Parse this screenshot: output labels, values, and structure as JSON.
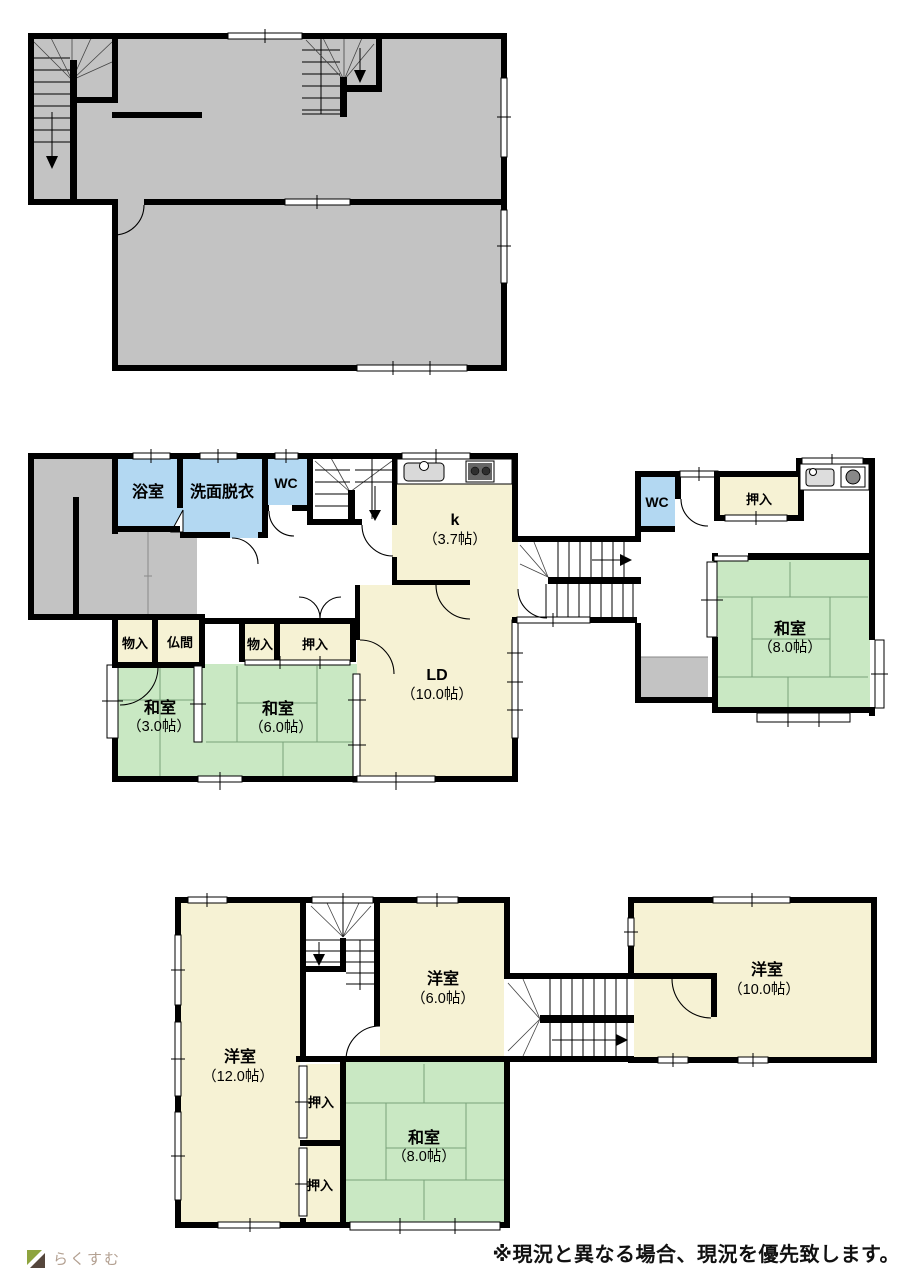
{
  "colors": {
    "wall": "#000000",
    "floor_gray": "#c3c3c3",
    "room_cream": "#f6f2d4",
    "room_green": "#c9e8c3",
    "room_blue": "#b3d8f2",
    "logo_green": "#8ea43e",
    "logo_brown": "#55463c",
    "logo_text": "#b3a091"
  },
  "floor1": {
    "bath": "浴室",
    "washroom": "洗面脱衣",
    "wc_left": "WC",
    "kitchen": "k",
    "kitchen_size": "（3.7帖）",
    "ld": "LD",
    "ld_size": "（10.0帖）",
    "storage_a": "物入",
    "butsuma": "仏間",
    "storage_b": "物入",
    "oshiire_a": "押入",
    "washitsu3": "和室",
    "washitsu3_size": "（3.0帖）",
    "washitsu6": "和室",
    "washitsu6_size": "（6.0帖）",
    "wc_right": "WC",
    "oshiire_b": "押入",
    "washitsu8": "和室",
    "washitsu8_size": "（8.0帖）"
  },
  "floor2": {
    "yoshitsu12": "洋室",
    "yoshitsu12_size": "（12.0帖）",
    "yoshitsu6": "洋室",
    "yoshitsu6_size": "（6.0帖）",
    "oshiire_a": "押入",
    "oshiire_b": "押入",
    "washitsu8": "和室",
    "washitsu8_size": "（8.0帖）",
    "yoshitsu10": "洋室",
    "yoshitsu10_size": "（10.0帖）"
  },
  "footer": {
    "logo_text": "らくすむ",
    "disclaimer": "※現況と異なる場合、現況を優先致します。"
  }
}
